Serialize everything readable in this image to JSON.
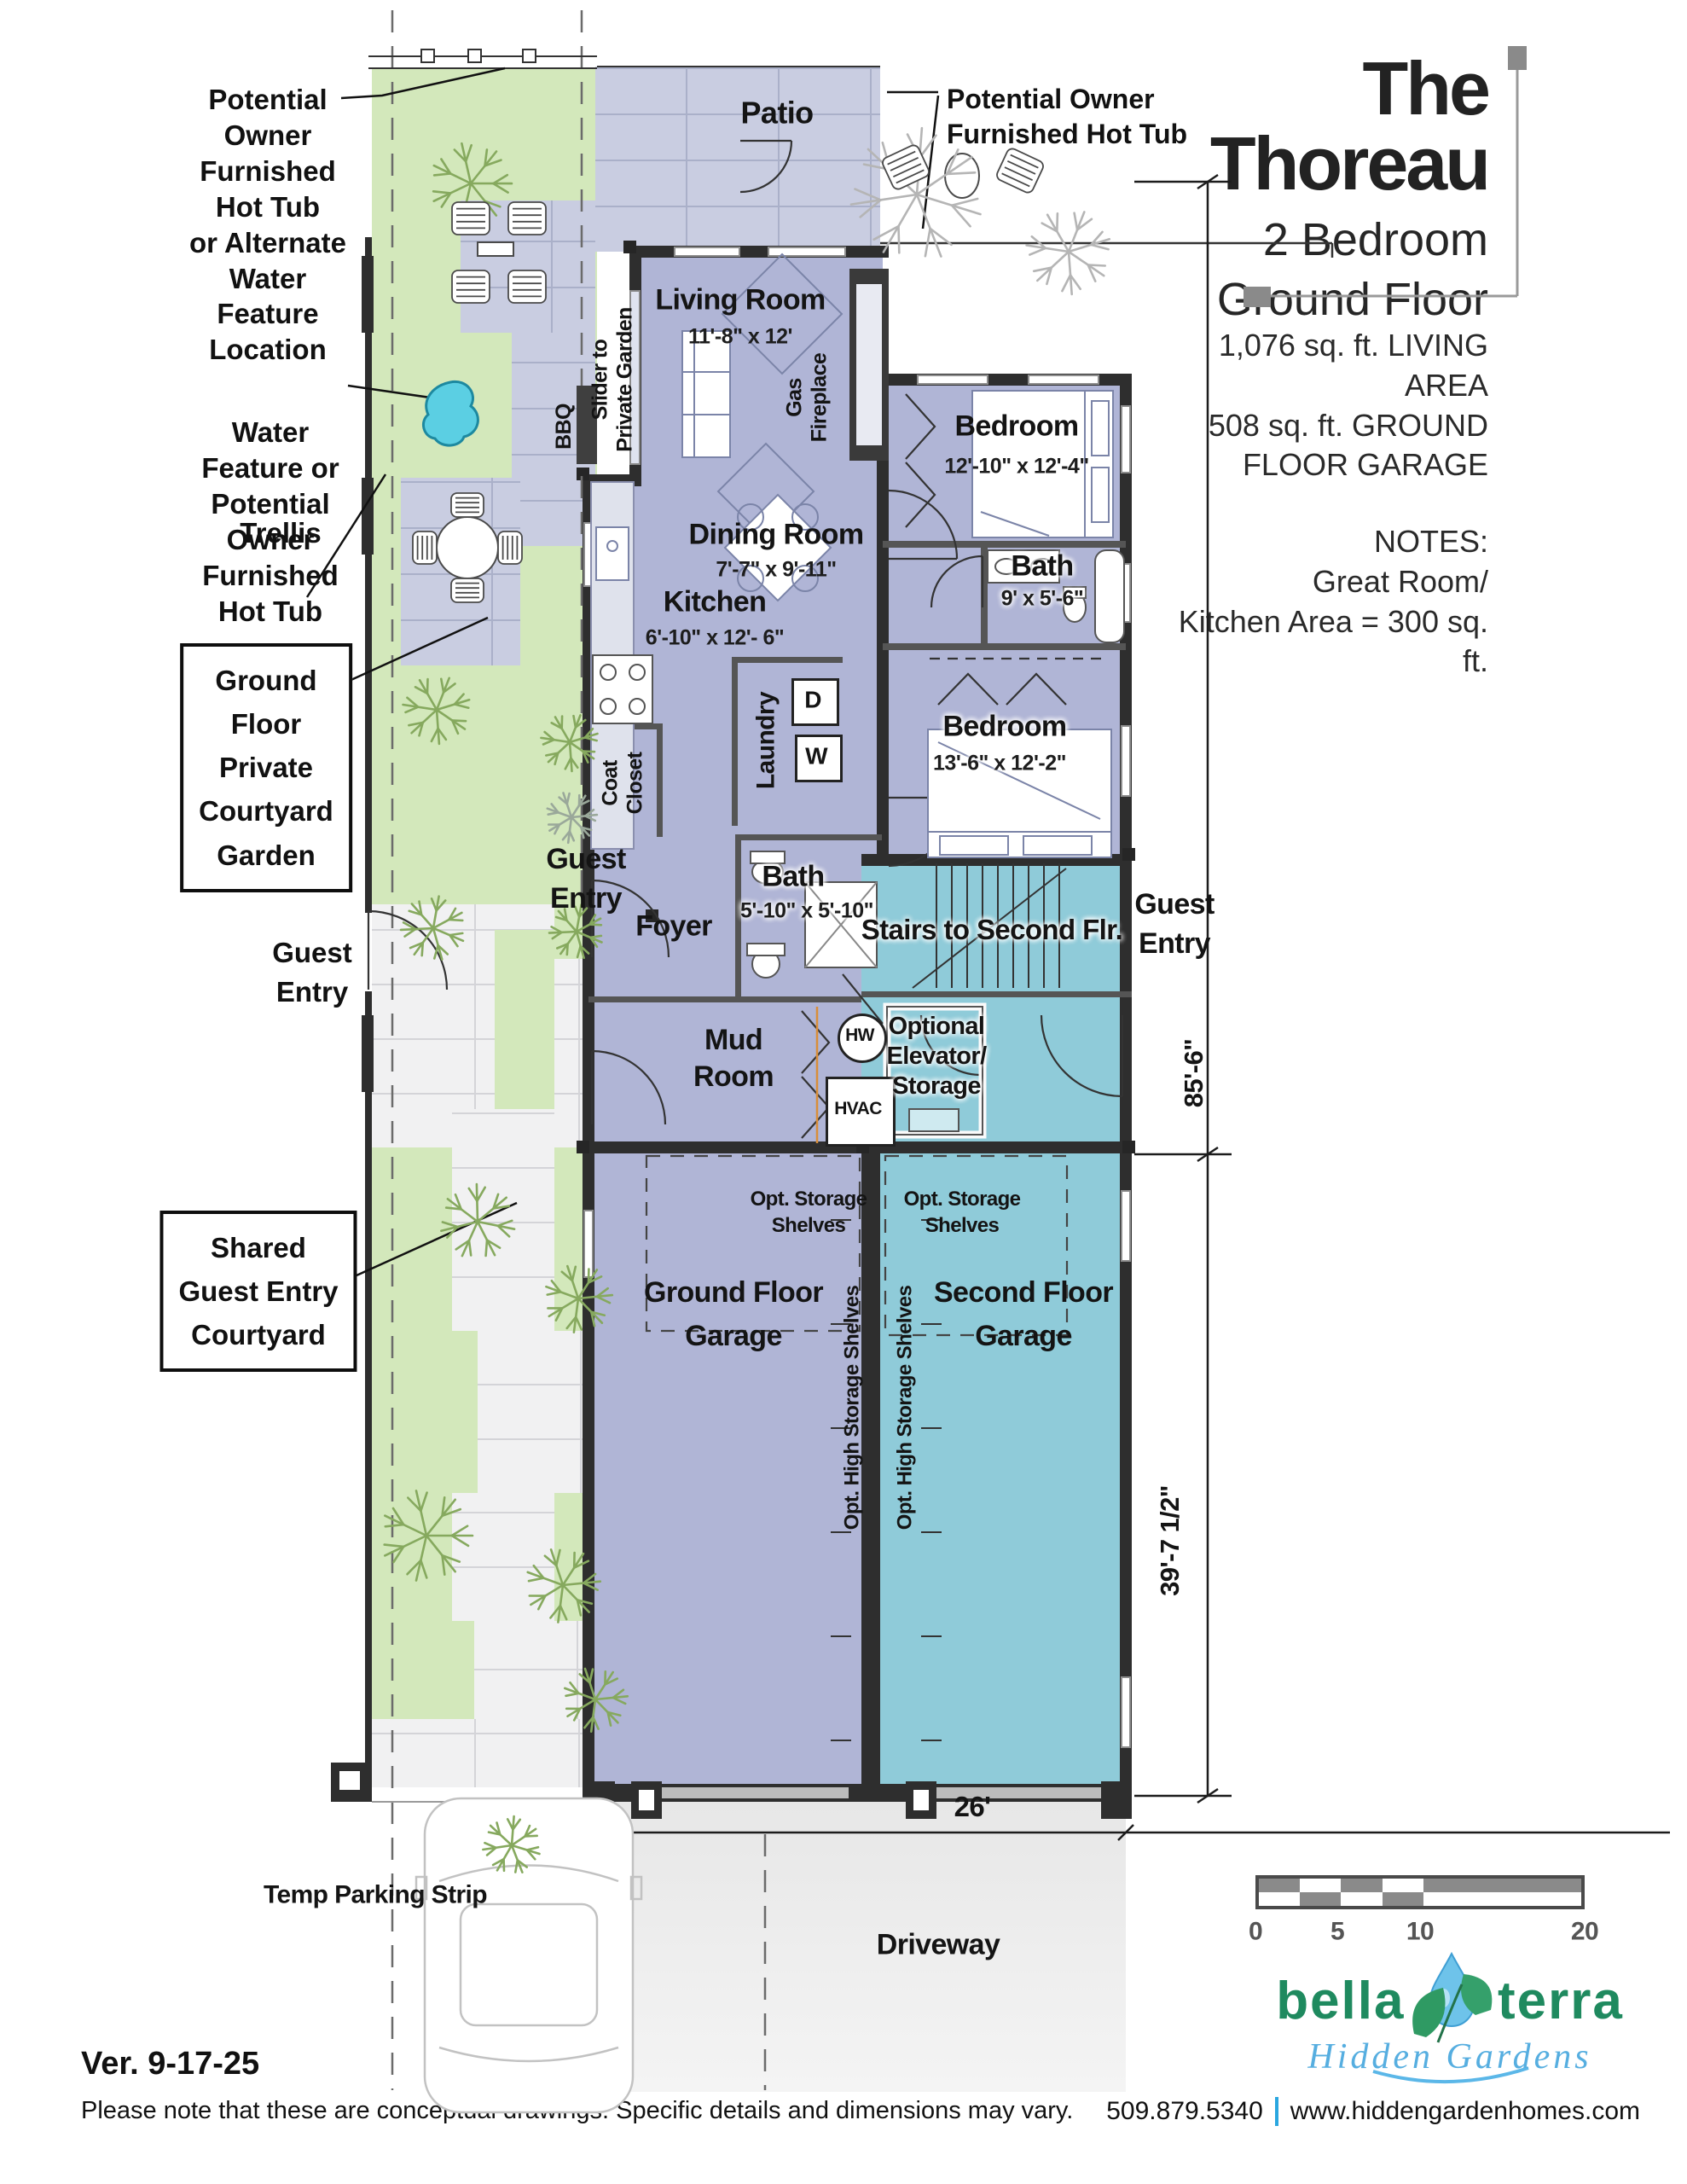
{
  "title_block": {
    "title": "The Thoreau",
    "subtitle_line1": "2 Bedroom",
    "subtitle_line2": "Ground Floor",
    "stat_line1": "1,076 sq. ft. LIVING AREA",
    "stat_line2": "508 sq. ft. GROUND",
    "stat_line3": "FLOOR GARAGE",
    "notes_heading": "NOTES:",
    "note_line1": "Great Room/",
    "note_line2": "Kitchen Area = 300 sq. ft."
  },
  "annotations": {
    "hot_tub_alt": {
      "lines": [
        "Potential",
        "Owner",
        "Furnished",
        "Hot Tub",
        "or Alternate",
        "Water",
        "Feature",
        "Location"
      ]
    },
    "water_feature": {
      "lines": [
        "Water",
        "Feature or",
        "Potential",
        "Owner",
        "Furnished",
        "Hot Tub"
      ]
    },
    "trellis": "Trellis",
    "courtyard_box": {
      "lines": [
        "Ground",
        "Floor",
        "Private",
        "Courtyard",
        "Garden"
      ]
    },
    "shared_box": {
      "lines": [
        "Shared",
        "Guest Entry",
        "Courtyard"
      ]
    },
    "hot_tub_right": {
      "lines": [
        "Potential Owner",
        "Furnished Hot Tub"
      ]
    },
    "guest_entry_left": {
      "lines": [
        "Guest",
        "Entry"
      ]
    },
    "guest_entry_mid": {
      "lines": [
        "Guest",
        "Entry"
      ]
    },
    "guest_entry_right": {
      "lines": [
        "Guest",
        "Entry"
      ]
    }
  },
  "rooms": {
    "patio": "Patio",
    "living": {
      "name": "Living Room",
      "dims": "11'-8\" x 12'"
    },
    "bedroom1": {
      "name": "Bedroom",
      "dims": "12'-10\" x 12'-4\""
    },
    "dining": {
      "name": "Dining Room",
      "dims": "7'-7\" x 9'-11\""
    },
    "bath1": {
      "name": "Bath",
      "dims": "9' x 5'-6\""
    },
    "kitchen": {
      "name": "Kitchen",
      "dims": "6'-10\" x 12'- 6\""
    },
    "bedroom2": {
      "name": "Bedroom",
      "dims": "13'-6\" x 12'-2\""
    },
    "bath2": {
      "name": "Bath",
      "dims": "5'-10\" x 5'-10\""
    },
    "laundry": "Laundry",
    "coat_closet": {
      "lines": [
        "Coat",
        "Closet"
      ]
    },
    "foyer": "Foyer",
    "mud_room": {
      "lines": [
        "Mud",
        "Room"
      ]
    },
    "stairs": "Stairs to Second Flr.",
    "elevator": {
      "lines": [
        "Optional",
        "Elevator/",
        "Storage"
      ]
    },
    "hw": "HW",
    "hvac": "HVAC",
    "dryer": "D",
    "washer": "W",
    "slider": {
      "lines": [
        "Slider to",
        "Private Garden"
      ]
    },
    "gas_fireplace": {
      "lines": [
        "Gas",
        "Fireplace"
      ]
    },
    "bbq": "BBQ",
    "storage_left": {
      "lines": [
        "Opt. Storage",
        "Shelves"
      ]
    },
    "storage_right": {
      "lines": [
        "Opt. Storage",
        "Shelves"
      ]
    },
    "garage_ground": {
      "lines": [
        "Ground Floor",
        "Garage"
      ]
    },
    "garage_second": {
      "lines": [
        "Second Floor",
        "Garage"
      ]
    },
    "high_storage_left": "Opt. High Storage Shelves",
    "high_storage_right": "Opt. High Storage Shelves"
  },
  "dimensions": {
    "upper": "85'-6\"",
    "lower": "39'-7 1/2\"",
    "width": "26'"
  },
  "site": {
    "temp_parking": "Temp Parking Strip",
    "driveway": "Driveway"
  },
  "scale_bar": {
    "t0": "0",
    "t5": "5",
    "t10": "10",
    "t20": "20"
  },
  "logo": {
    "word1": "bella",
    "word2": "terra",
    "tagline": "Hidden Gardens"
  },
  "footer": {
    "version": "Ver. 9-17-25",
    "disclaimer": "Please note that these are conceptual drawings. Specific details and dimensions may vary.",
    "phone": "509.879.5340",
    "website": "www.hiddengardenhomes.com"
  },
  "colors": {
    "interior_purple": "#b0b5d6",
    "garage_teal": "#8fcbd9",
    "garden_green": "#d3e8bb",
    "paver": "#c9cde1",
    "wall": "#2e2e2e",
    "pond_blue": "#5bcfe3",
    "brand_green": "#1f8a5f",
    "brand_blue": "#56aee0",
    "accent_blue": "#2aa7e0"
  }
}
